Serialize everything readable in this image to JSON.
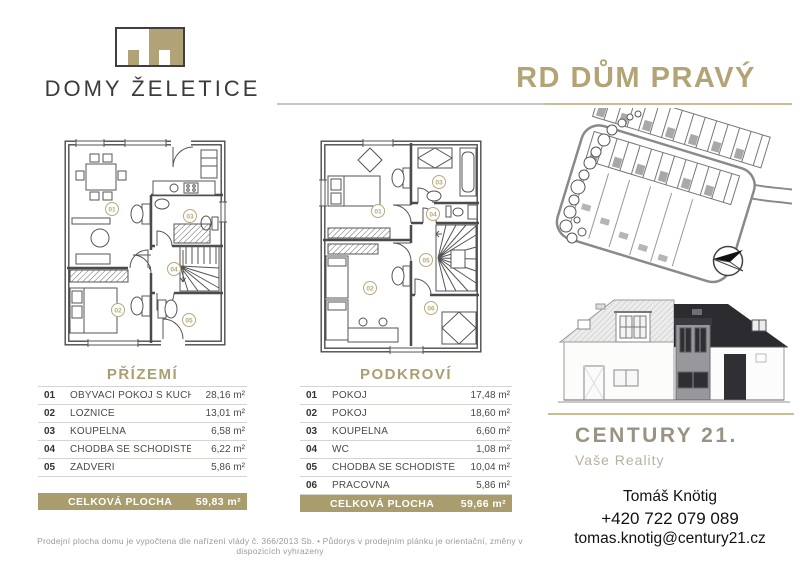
{
  "page": {
    "logo_text": "DOMY ŽELETICE",
    "title": "RD DŮM PRAVÝ"
  },
  "tables": {
    "ground_floor": {
      "title": "PŘÍZEMÍ",
      "rows": [
        {
          "num": "01",
          "name": "OBÝVACÍ POKOJ S KUCHYNÍ",
          "area": "28,16 m²"
        },
        {
          "num": "02",
          "name": "LOŽNICE",
          "area": "13,01 m²"
        },
        {
          "num": "03",
          "name": "KOUPELNA",
          "area": "6,58 m²"
        },
        {
          "num": "04",
          "name": "CHODBA SE SCHODIŠTĚM",
          "area": "6,22 m²"
        },
        {
          "num": "05",
          "name": "ZÁDVEŘÍ",
          "area": "5,86 m²"
        }
      ],
      "total_label": "CELKOVÁ PLOCHA",
      "total": "59,83 m²"
    },
    "attic": {
      "title": "PODKROVÍ",
      "rows": [
        {
          "num": "01",
          "name": "POKOJ",
          "area": "17,48 m²"
        },
        {
          "num": "02",
          "name": "POKOJ",
          "area": "18,60 m²"
        },
        {
          "num": "03",
          "name": "KOUPELNA",
          "area": "6,60 m²"
        },
        {
          "num": "04",
          "name": "WC",
          "area": "1,08 m²"
        },
        {
          "num": "05",
          "name": "CHODBA SE SCHODIŠTĚM",
          "area": "10,04 m²"
        },
        {
          "num": "06",
          "name": "PRACOVNA",
          "area": "5,86 m²"
        }
      ],
      "total_label": "CELKOVÁ PLOCHA",
      "total": "59,66 m²"
    }
  },
  "company": {
    "name": "CENTURY 21.",
    "tagline": "Vaše Reality"
  },
  "agent": {
    "name": "Tomáš Knötig",
    "phone": "+420 722 079 089",
    "email": "tomas.knotig@century21.cz"
  },
  "disclaimer": "Prodejní plocha domu je vypočtena dle nařízení vlády č. 366/2013 Sb.  •  Půdorys v prodejním plánku je orientační, změny v dispozicích vyhrazeny",
  "colors": {
    "accent_tan": "#b3a475",
    "bar_tan": "#a99c6d",
    "roof_dark": "#2c2c30"
  }
}
